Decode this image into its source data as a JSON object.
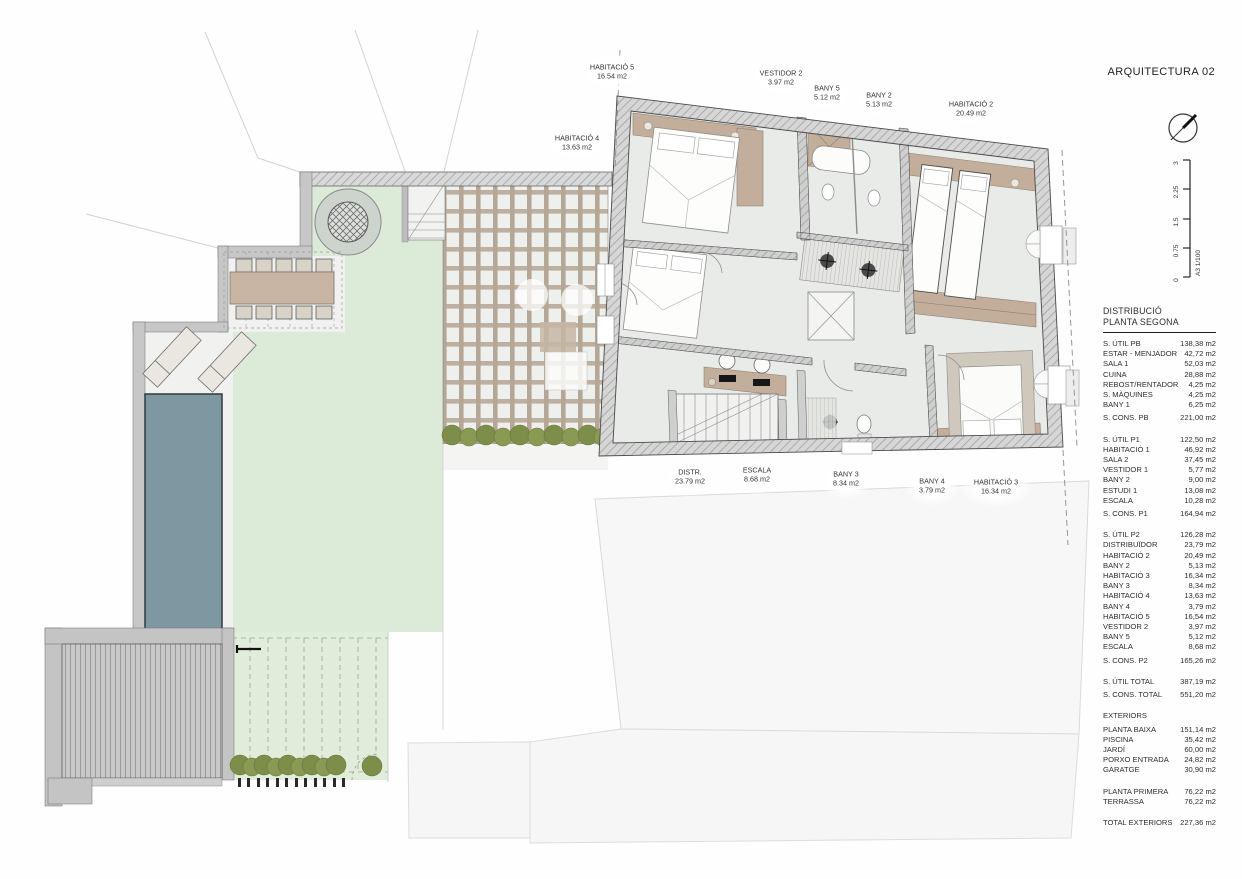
{
  "sheet": {
    "title": "ARQUITECTURA 02",
    "scale_label": "A3  1/100",
    "scale_ticks": [
      "3",
      "2.25",
      "1.5",
      "0.75",
      "0"
    ]
  },
  "plan_labels": [
    {
      "name": "HABITACIÓ 5",
      "area": "16.54 m2"
    },
    {
      "name": "HABITACIÓ 4",
      "area": "13.63 m2"
    },
    {
      "name": "VESTIDOR 2",
      "area": "3.97 m2"
    },
    {
      "name": "BANY 5",
      "area": "5.12 m2"
    },
    {
      "name": "BANY 2",
      "area": "5.13 m2"
    },
    {
      "name": "HABITACIÓ 2",
      "area": "20.49 m2"
    },
    {
      "name": "DISTR.",
      "area": "23.79 m2"
    },
    {
      "name": "ESCALA",
      "area": "8.68 m2"
    },
    {
      "name": "BANY 3",
      "area": "8.34 m2"
    },
    {
      "name": "BANY 4",
      "area": "3.79 m2"
    },
    {
      "name": "HABITACIÓ 3",
      "area": "16.34 m2"
    }
  ],
  "schedule": {
    "heading1": "DISTRIBUCIÓ",
    "heading2": "PLANTA SEGONA",
    "rows": [
      {
        "l": "S. ÚTIL PB",
        "v": "138,38 m2"
      },
      {
        "l": "ESTAR - MENJADOR",
        "v": "42,72 m2"
      },
      {
        "l": "SALA 1",
        "v": "52,03 m2"
      },
      {
        "l": "CUINA",
        "v": "28,88 m2"
      },
      {
        "l": "REBOST/RENTADOR",
        "v": "4,25 m2"
      },
      {
        "l": "S. MÀQUINES",
        "v": "4,25 m2"
      },
      {
        "l": "BANY 1",
        "v": "6,25 m2"
      },
      {
        "l": "S. CONS. PB",
        "v": "221,00 m2"
      },
      {
        "l": "S. ÚTIL P1",
        "v": "122,50 m2"
      },
      {
        "l": "HABITACIÓ 1",
        "v": "46,92 m2"
      },
      {
        "l": "SALA 2",
        "v": "37,45 m2"
      },
      {
        "l": "VESTIDOR 1",
        "v": "5,77 m2"
      },
      {
        "l": "BANY 2",
        "v": "9,00 m2"
      },
      {
        "l": "ESTUDI 1",
        "v": "13,08 m2"
      },
      {
        "l": "ESCALA",
        "v": "10,28 m2"
      },
      {
        "l": "S. CONS. P1",
        "v": "164,94 m2"
      },
      {
        "l": "S. ÚTIL P2",
        "v": "126,28 m2"
      },
      {
        "l": "DISTRIBUÏDOR",
        "v": "23,79 m2"
      },
      {
        "l": "HABITACIÓ 2",
        "v": "20,49 m2"
      },
      {
        "l": "BANY 2",
        "v": "5,13 m2"
      },
      {
        "l": "HABITACIÓ 3",
        "v": "16,34 m2"
      },
      {
        "l": "BANY 3",
        "v": "8,34 m2"
      },
      {
        "l": "HABITACIÓ 4",
        "v": "13,63 m2"
      },
      {
        "l": "BANY 4",
        "v": "3,79 m2"
      },
      {
        "l": "HABITACIÓ 5",
        "v": "16,54 m2"
      },
      {
        "l": "VESTIDOR 2",
        "v": "3,97 m2"
      },
      {
        "l": "BANY 5",
        "v": "5,12 m2"
      },
      {
        "l": "ESCALA",
        "v": "8,68 m2"
      },
      {
        "l": "S. CONS. P2",
        "v": "165,26 m2"
      },
      {
        "l": "S. ÚTIL TOTAL",
        "v": "387,19 m2"
      },
      {
        "l": "S. CONS. TOTAL",
        "v": "551,20 m2"
      },
      {
        "l": "EXTERIORS",
        "v": ""
      },
      {
        "l": "PLANTA BAIXA",
        "v": "151,14 m2"
      },
      {
        "l": "PISCINA",
        "v": "35,42 m2"
      },
      {
        "l": "JARDÍ",
        "v": "60,00 m2"
      },
      {
        "l": "PORXO ENTRADA",
        "v": "24,82 m2"
      },
      {
        "l": "GARATGE",
        "v": "30,90 m2"
      },
      {
        "l": "PLANTA PRIMERA",
        "v": "76,22 m2"
      },
      {
        "l": "TERRASSA",
        "v": "76,22 m2"
      },
      {
        "l": "TOTAL EXTERIORS",
        "v": "227,36 m2"
      }
    ]
  },
  "colors": {
    "lawn": "#dcead8",
    "pool": "#7e98a2",
    "wall": "#c7c7c7",
    "wood": "#c3ad9b",
    "shrub": "#7c8e49",
    "floor": "#e9ebe9",
    "parcel": "#f7f7f8",
    "ink": "#3c3c3c"
  }
}
